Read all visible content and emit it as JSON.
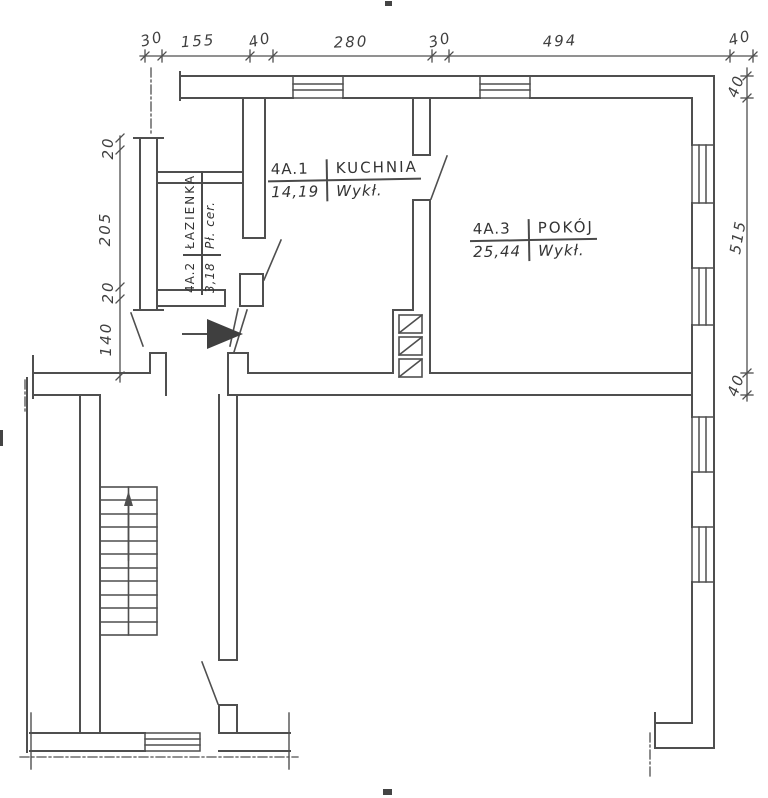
{
  "rooms": [
    {
      "id": "4A.1",
      "name": "KUCHNIA",
      "area": "14,19",
      "floor": "Wykł."
    },
    {
      "id": "4A.2",
      "name": "ŁAZIENKA",
      "area": "3,18",
      "floor": "Pł. cer."
    },
    {
      "id": "4A.3",
      "name": "POKÓJ",
      "area": "25,44",
      "floor": "Wykł."
    }
  ],
  "dimensions": {
    "top": [
      "30",
      "155",
      "40",
      "280",
      "30",
      "494",
      "40"
    ],
    "right": [
      "40",
      "515",
      "40"
    ],
    "left": [
      "20",
      "205",
      "20",
      "140"
    ]
  },
  "symbols": {
    "entrance_arrow": "entrance-direction-arrow",
    "stairs_arrow": "stairs-up-arrow",
    "flue_boxes": 3,
    "windows_top_wall": 2,
    "windows_right_wall": 4
  },
  "colors": {
    "line": "#4f4f4f",
    "text": "#3a3a3a",
    "background": "#ffffff"
  }
}
